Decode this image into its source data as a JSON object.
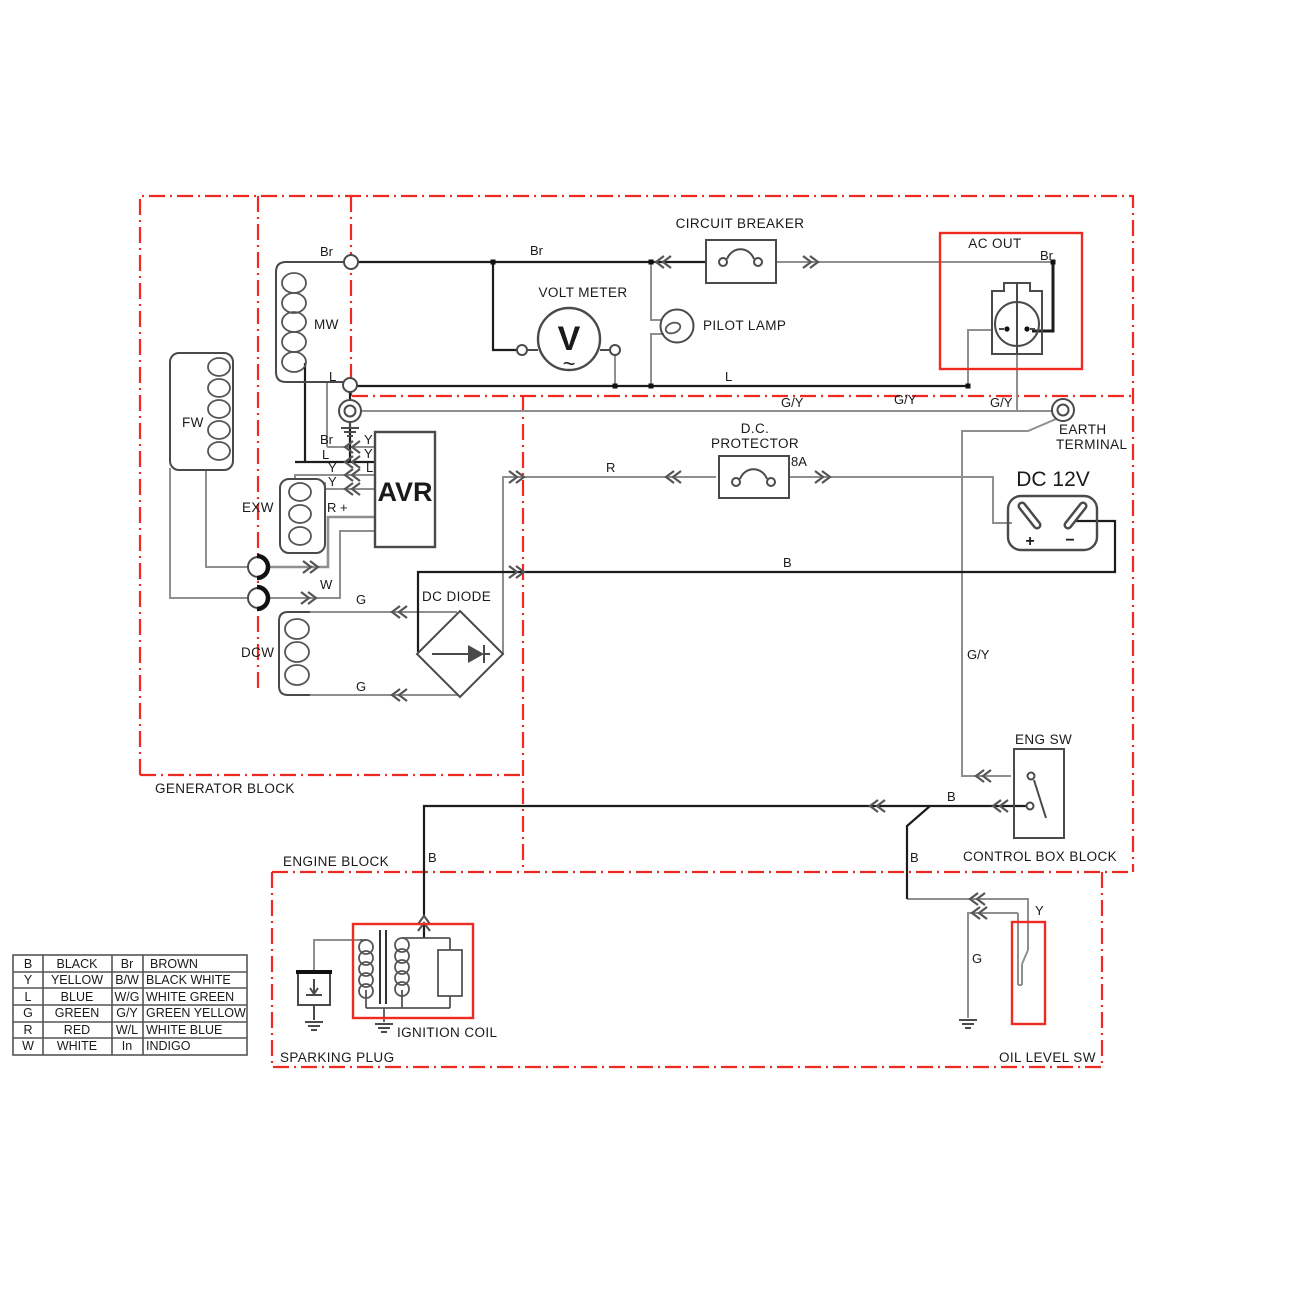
{
  "labels": {
    "generator_block": "GENERATOR BLOCK",
    "engine_block": "ENGINE BLOCK",
    "control_box_block": "CONTROL BOX BLOCK",
    "circuit_breaker": "CIRCUIT BREAKER",
    "volt_meter": "VOLT METER",
    "volt_meter_v": "V",
    "volt_meter_wave": "~",
    "pilot_lamp": "PILOT LAMP",
    "ac_out": "AC OUT",
    "earth_line1": "EARTH",
    "earth_line2": "TERMINAL",
    "dc_protector_line1": "D.C.",
    "dc_protector_line2": "PROTECTOR",
    "dc_protector_rating": "8A",
    "dc_12v": "DC 12V",
    "dc_plus": "+",
    "dc_minus": "−",
    "dc_diode": "DC DIODE",
    "avr": "AVR",
    "eng_sw": "ENG SW",
    "ignition_coil": "IGNITION COIL",
    "sparking_plug": "SPARKING PLUG",
    "oil_level_sw": "OIL LEVEL SW",
    "fw": "FW",
    "mw": "MW",
    "exw": "EXW",
    "dcw": "DCW"
  },
  "wire_labels": {
    "br_generator": "Br",
    "br_breaker": "Br",
    "br_ac_out": "Br",
    "l_generator": "L",
    "l_ac_out": "L",
    "gy_1": "G/Y",
    "gy_2": "G/Y",
    "gy_3": "G/Y",
    "gy_control": "G/Y",
    "r_protector": "R",
    "r_plus": "R +",
    "b_dc": "B",
    "b_eng_sw": "B",
    "b_down": "B",
    "b_ignition": "B",
    "w_brush": "W",
    "g_diode_top": "G",
    "g_diode_bottom": "G",
    "g_oil": "G",
    "y_oil": "Y"
  },
  "avr_pins": {
    "left": [
      "Br",
      "L",
      "Y",
      "Y"
    ],
    "right": [
      "Y",
      "Y",
      "L"
    ]
  },
  "legend": {
    "rows": [
      {
        "c1": "B",
        "n1": "BLACK",
        "c2": "Br",
        "n2": "BROWN"
      },
      {
        "c1": "Y",
        "n1": "YELLOW",
        "c2": "B/W",
        "n2": "BLACK WHITE"
      },
      {
        "c1": "L",
        "n1": "BLUE",
        "c2": "W/G",
        "n2": "WHITE GREEN"
      },
      {
        "c1": "G",
        "n1": "GREEN",
        "c2": "G/Y",
        "n2": "GREEN YELLOW"
      },
      {
        "c1": "R",
        "n1": "RED",
        "c2": "W/L",
        "n2": "WHITE BLUE"
      },
      {
        "c1": "W",
        "n1": "WHITE",
        "c2": "In",
        "n2": "INDIGO"
      }
    ]
  },
  "colors": {
    "block_red": "#ee2a22",
    "wire_gray": "#8f8f8f",
    "wire_black": "#1c1c1c",
    "text": "#1a1a1a"
  }
}
